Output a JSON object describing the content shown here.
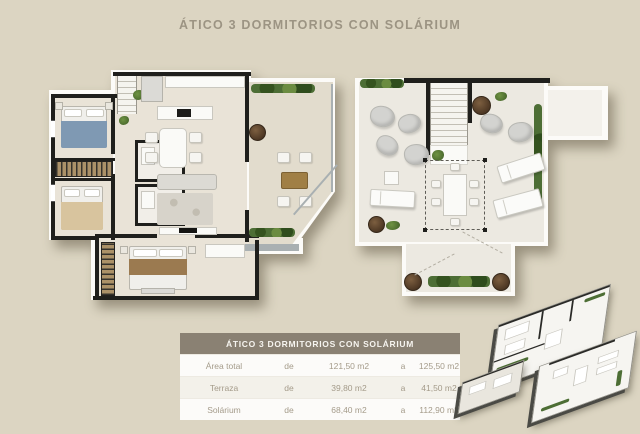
{
  "title": "ÁTICO 3 DORMITORIOS CON SOLÁRIUM",
  "area_table": {
    "header": "ÁTICO 3 DORMITORIOS CON SOLÁRIUM",
    "rows": [
      {
        "label": "Área total",
        "from_word": "de",
        "from_value": "121,50 m2",
        "to_word": "a",
        "to_value": "125,50 m2"
      },
      {
        "label": "Terraza",
        "from_word": "de",
        "from_value": "39,80 m2",
        "to_word": "a",
        "to_value": "41,50 m2"
      },
      {
        "label": "Solárium",
        "from_word": "de",
        "from_value": "68,40 m2",
        "to_word": "a",
        "to_value": "112,90 m2"
      }
    ]
  },
  "colors": {
    "background": "#dcd5c2",
    "table_header_bg": "#8a8173",
    "wall": "#1f1f1c",
    "interior_floor": "#e9e3d7",
    "terrace_floor": "#e2dccd",
    "hedge_green": "#4d6e35",
    "planter_brown": "#5d452e",
    "title_text": "#9c9483"
  }
}
